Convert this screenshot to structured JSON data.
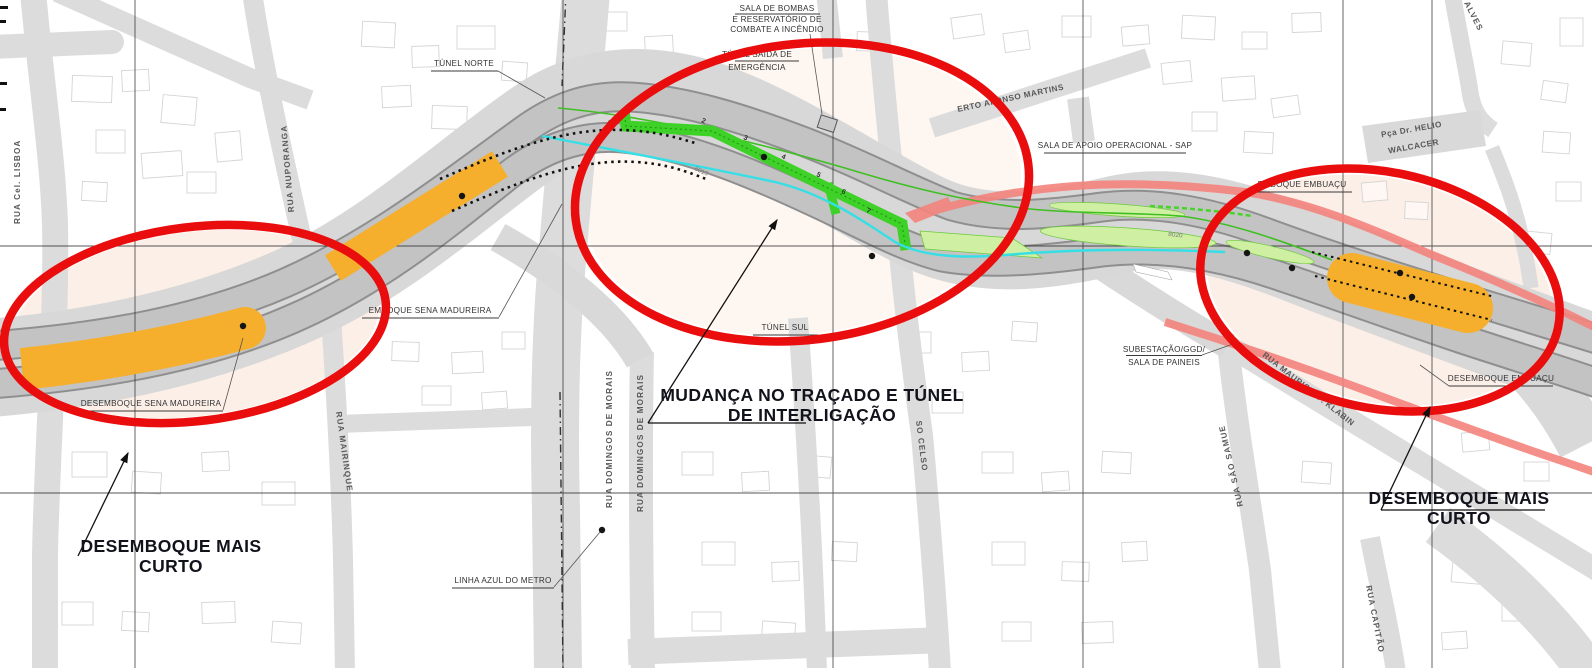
{
  "map": {
    "title": "Plano de traçado de túnel urbano (Sena Madureira / Embuaçu)",
    "annotations": {
      "tunel_norte": "TÚNEL NORTE",
      "sala_bombas": [
        "SALA DE BOMBAS",
        "E RESERVATÓRIO DE",
        "COMBATE A INCÊNDIO"
      ],
      "tunel_emergencia": [
        "TÚNEL SAÍDA DE",
        "EMERGÊNCIA"
      ],
      "sala_apoio": "SALA DE APOIO OPERACIONAL - SAP",
      "emboque_sena": "EMBOQUE SENA MADUREIRA",
      "desemboque_sena": "DESEMBOQUE SENA MADUREIRA",
      "tunel_sul": "TÚNEL SUL",
      "linha_azul": "LINHA AZUL DO METRO",
      "subestacao": [
        "SUBESTAÇÃO/GGD/",
        "SALA DE PAINEIS"
      ],
      "emboque_embuacu": "EMBOQUE EMBUAÇU",
      "desemboque_embuacu": "DESEMBOQUE EMBUAÇU"
    },
    "callouts": {
      "left": [
        "DESEMBOQUE MAIS",
        "CURTO"
      ],
      "center": [
        "MUDANÇA NO TRAÇADO E TÚNEL",
        "DE INTERLIGAÇÃO"
      ],
      "right": [
        "DESEMBOQUE MAIS",
        "CURTO"
      ]
    },
    "streets": {
      "cel_lisboa": "RUA Cel. LISBOA",
      "nuporanga": "RUA NUPORANGA",
      "mairinque": "RUA MAIRINQUE",
      "domingos_1": "RUA DOMINGOS DE MORAIS",
      "domingos_2": "RUA DOMINGOS DE MORAIS",
      "afonso_martins": "ERTO AFONSO MARTINS",
      "pca_helio": [
        "Pça Dr. HELIO",
        "WALCACER"
      ],
      "alves": "ALVES",
      "so_celso": "SO CELSO",
      "sao_samuel": "RUA SÃO SAMUE",
      "klabin": "RUA MAURICIO F. KLABIN",
      "capitao": "RUA CAPITÃO"
    },
    "markers": {
      "tunnel_segments": [
        "2",
        "3",
        "4",
        "5",
        "6",
        "7"
      ],
      "station_codes": [
        "8010",
        "8020"
      ]
    },
    "colors": {
      "highlight_red": "#e90d0d",
      "works_orange": "#f5af2d",
      "tunnel_green": "#3ed228",
      "pale_green": "#cff0a2",
      "metro_cyan": "#35dfe6",
      "edge_salmon": "#f4837d"
    }
  }
}
